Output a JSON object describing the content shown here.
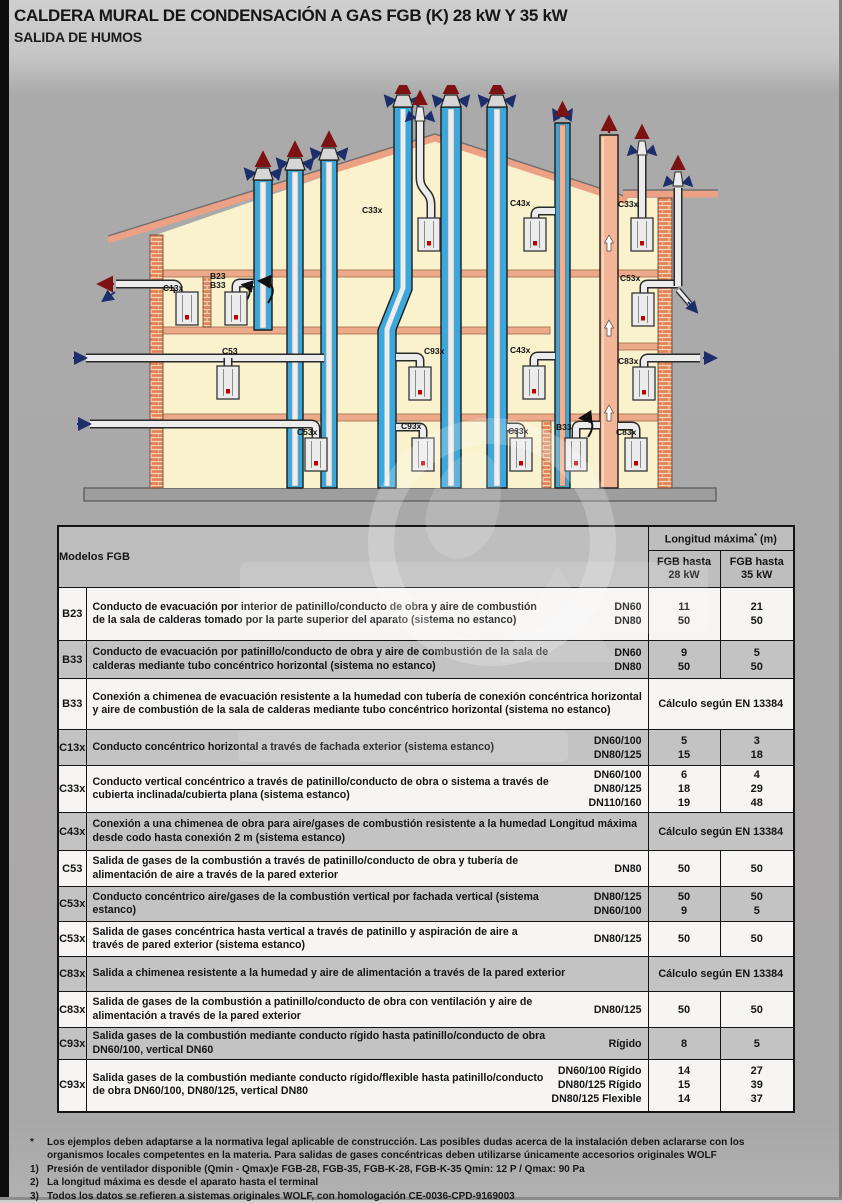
{
  "page": {
    "title": "CALDERA MURAL DE CONDENSACIÓN A GAS FGB (K) 28 kW Y 35 kW",
    "subtitle": "SALIDA DE HUMOS"
  },
  "diagram": {
    "units": [
      {
        "id": "c13x",
        "label": "C13x"
      },
      {
        "id": "b23",
        "label": "B23"
      },
      {
        "id": "b33_top",
        "label": "B33"
      },
      {
        "id": "c33x_top",
        "label": "C33x"
      },
      {
        "id": "c43x_top",
        "label": "C43x"
      },
      {
        "id": "c33x_tr",
        "label": "C33x"
      },
      {
        "id": "c53",
        "label": "C53"
      },
      {
        "id": "c53x_right",
        "label": "C53x"
      },
      {
        "id": "c93x_mid",
        "label": "C93x"
      },
      {
        "id": "c43x_mid",
        "label": "C43x"
      },
      {
        "id": "c83x_mid",
        "label": "C83x"
      },
      {
        "id": "c53x_bot",
        "label": "C53x"
      },
      {
        "id": "c93x_bot",
        "label": "C93x"
      },
      {
        "id": "c33x_bot",
        "label": "C33x"
      },
      {
        "id": "b33_bot",
        "label": "B33"
      },
      {
        "id": "c83x_br",
        "label": "C83x"
      }
    ]
  },
  "table": {
    "models_header": "Modelos FGB",
    "length_header": {
      "label": "Longitud máxima",
      "sup": "*",
      "unit": " (m)"
    },
    "col28": {
      "line1": "FGB hasta",
      "line2": "28 kW"
    },
    "col35": {
      "line1": "FGB hasta",
      "line2": "35 kW"
    },
    "rows": [
      {
        "model": "B23",
        "description": "Conducto de evacuación por interior de patinillo/conducto de obra y aire de combustión de la sala de calderas tomado por la parte superior del aparato (sistema no estanco)",
        "specs": [
          {
            "dn": "DN60",
            "v28": "11",
            "v35": "21"
          },
          {
            "dn": "DN80",
            "v28": "50",
            "v35": "50"
          }
        ]
      },
      {
        "model": "B33",
        "description": "Conducto de evacuación por patinillo/conducto de obra y aire de combustión de la sala de calderas mediante tubo concéntrico horizontal (sistema no estanco)",
        "specs": [
          {
            "dn": "DN60",
            "v28": "9",
            "v35": "5"
          },
          {
            "dn": "DN80",
            "v28": "50",
            "v35": "50"
          }
        ]
      },
      {
        "model": "B33",
        "description": "Conexión a chimenea de evacuación resistente a la humedad con tubería de conexión concéntrica horizontal y aire de combustión de la sala de calderas mediante tubo concéntrico horizontal (sistema no estanco)",
        "calc": "Cálculo según EN 13384"
      },
      {
        "model": "C13x",
        "description": "Conducto concéntrico horizontal a través de fachada exterior (sistema estanco)",
        "specs": [
          {
            "dn": "DN60/100",
            "v28": "5",
            "v35": "3"
          },
          {
            "dn": "DN80/125",
            "v28": "15",
            "v35": "18"
          }
        ]
      },
      {
        "model": "C33x",
        "description": "Conducto vertical concéntrico a través de patinillo/conducto de obra o sistema a través de cubierta inclinada/cubierta plana (sistema estanco)",
        "specs": [
          {
            "dn": "DN60/100",
            "v28": "6",
            "v35": "4"
          },
          {
            "dn": "DN80/125",
            "v28": "18",
            "v35": "29"
          },
          {
            "dn": "DN110/160",
            "v28": "19",
            "v35": "48"
          }
        ]
      },
      {
        "model": "C43x",
        "description": "Conexión a una chimenea de obra para aire/gases de combustión resistente a la humedad Longitud máxima desde codo hasta conexión 2 m (sistema estanco)",
        "calc": "Cálculo según EN 13384"
      },
      {
        "model": "C53",
        "description": "Salida de gases de la combustión a través de patinillo/conducto de obra y tubería de alimentación de aire a través de la pared exterior",
        "specs": [
          {
            "dn": "DN80",
            "v28": "50",
            "v35": "50"
          }
        ]
      },
      {
        "model": "C53x",
        "description": "Conducto concéntrico aire/gases de la combustión vertical por fachada vertical (sistema estanco)",
        "specs": [
          {
            "dn": "DN80/125",
            "v28": "50",
            "v35": "50"
          },
          {
            "dn": "DN60/100",
            "v28": "9",
            "v35": "5"
          }
        ]
      },
      {
        "model": "C53x",
        "description": "Salida de gases concéntrica hasta vertical a través de patinillo y aspiración de aire a través de pared exterior (sistema estanco)",
        "specs": [
          {
            "dn": "DN80/125",
            "v28": "50",
            "v35": "50"
          }
        ]
      },
      {
        "model": "C83x",
        "description": "Salida a chimenea resistente a la humedad y aire de alimentación a través de la pared exterior",
        "calc": "Cálculo según EN 13384"
      },
      {
        "model": "C83x",
        "description": "Salida de gases de la combustión a patinillo/conducto de obra con ventilación y aire de alimentación a través de la pared exterior",
        "specs": [
          {
            "dn": "DN80/125",
            "v28": "50",
            "v35": "50"
          }
        ]
      },
      {
        "model": "C93x",
        "description": "Salida gases de la combustión mediante conducto rígido hasta patinillo/conducto de obra DN60/100, vertical DN60",
        "specs": [
          {
            "dn": "Rígido",
            "v28": "8",
            "v35": "5"
          }
        ]
      },
      {
        "model": "C93x",
        "description": "Salida gases de la combustión mediante conducto rígido/flexible hasta patinillo/conducto de obra DN60/100, DN80/125, vertical DN80",
        "specs": [
          {
            "dn": "DN60/100  Rígido",
            "v28": "14",
            "v35": "27"
          },
          {
            "dn": "DN80/125 Rígido",
            "v28": "15",
            "v35": "39"
          },
          {
            "dn": "DN80/125 Flexible",
            "v28": "14",
            "v35": "37"
          }
        ]
      }
    ]
  },
  "footnotes": {
    "items": [
      {
        "marker": "*",
        "text": "Los ejemplos deben adaptarse a la normativa legal aplicable de construcción. Las posibles dudas acerca de la instalación deben aclararse con los organismos locales competentes en la materia. Para salidas de gases concéntricas deben utilizarse únicamente accesorios originales WOLF"
      },
      {
        "marker": "1)",
        "text": "Presión de ventilador disponible (Qmin - Qmax)e FGB-28, FGB-35, FGB-K-28, FGB-K-35 Qmin: 12 P / Qmax: 90 Pa"
      },
      {
        "marker": "2)",
        "text": "La longitud máxima es desde el aparato hasta el terminal"
      },
      {
        "marker": "3)",
        "text": "Todos los datos se refieren a sistemas originales WOLF, con homologación CE-0036-CPD-9169003"
      }
    ]
  }
}
